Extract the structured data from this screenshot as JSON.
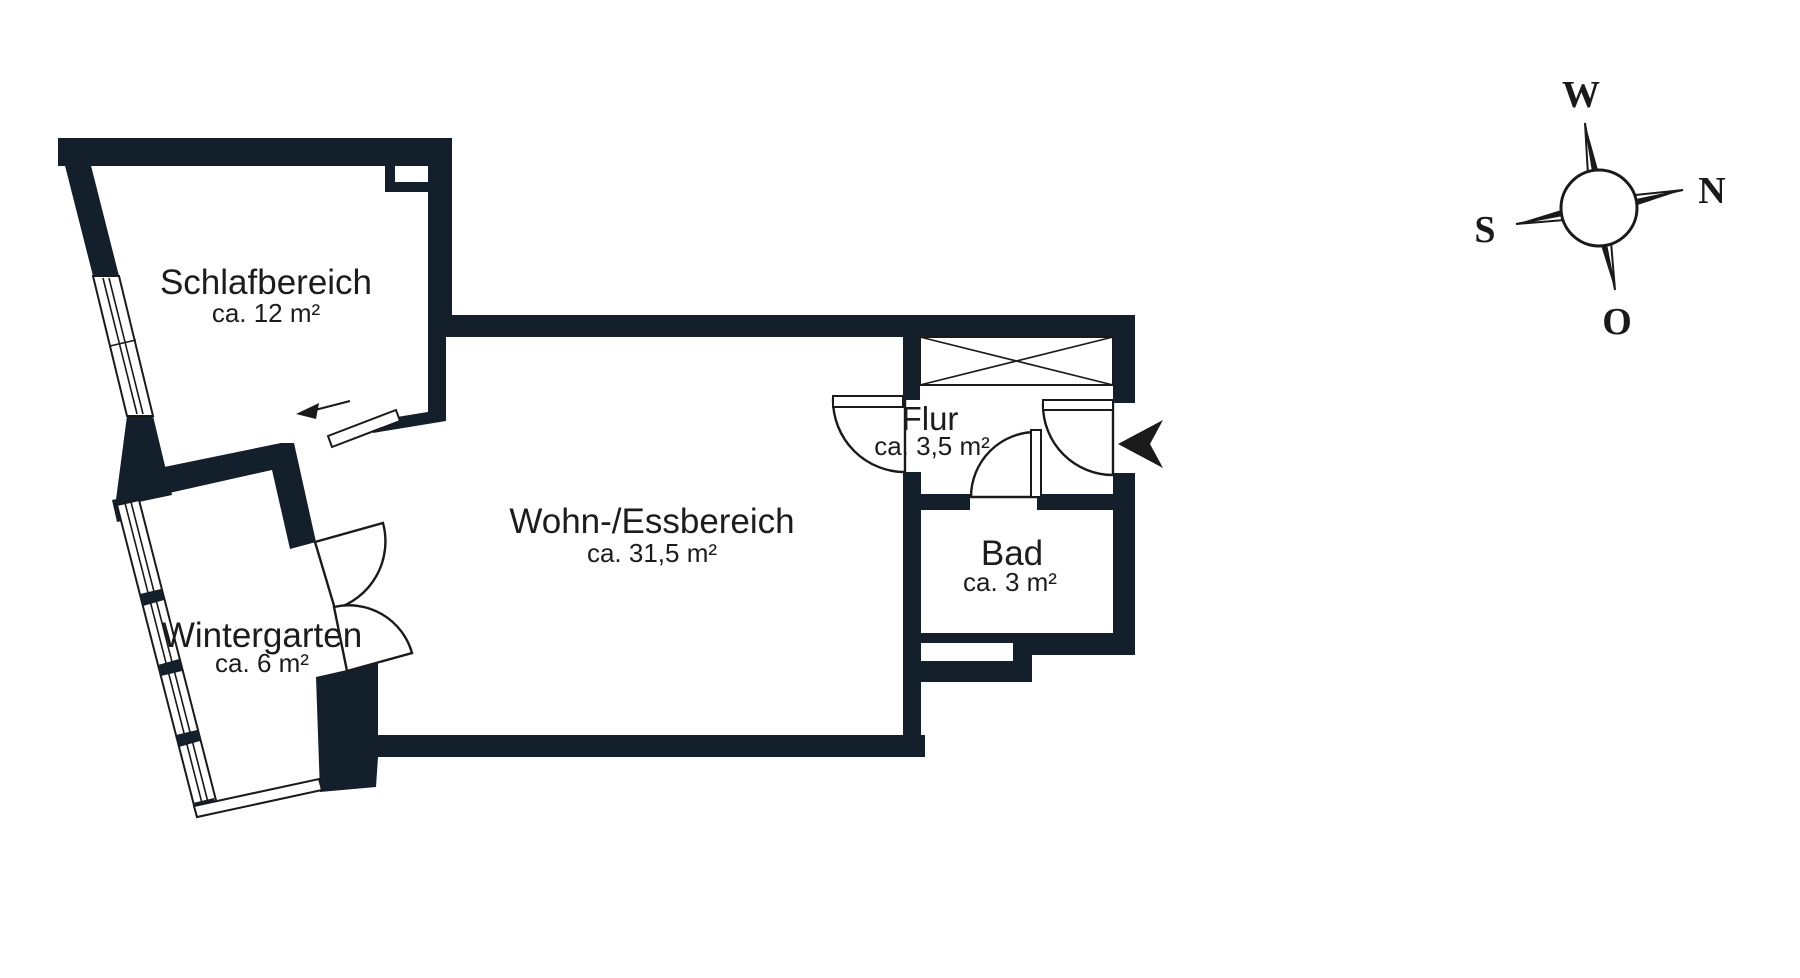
{
  "rooms": [
    {
      "name": "Schlafbereich",
      "area": "ca. 12 m²"
    },
    {
      "name": "Wohn-/Essbereich",
      "area": "ca. 31,5 m²"
    },
    {
      "name": "Wintergarten",
      "area": "ca. 6 m²"
    },
    {
      "name": "Flur",
      "area": "ca. 3,5 m²"
    },
    {
      "name": "Bad",
      "area": "ca. 3 m²"
    }
  ],
  "compass": {
    "top": "W",
    "right": "N",
    "left": "S",
    "bottom": "O"
  },
  "colors": {
    "wall": "#131f2b",
    "line": "#1a1a1a",
    "text": "#1c1c1c",
    "background": "#ffffff"
  }
}
